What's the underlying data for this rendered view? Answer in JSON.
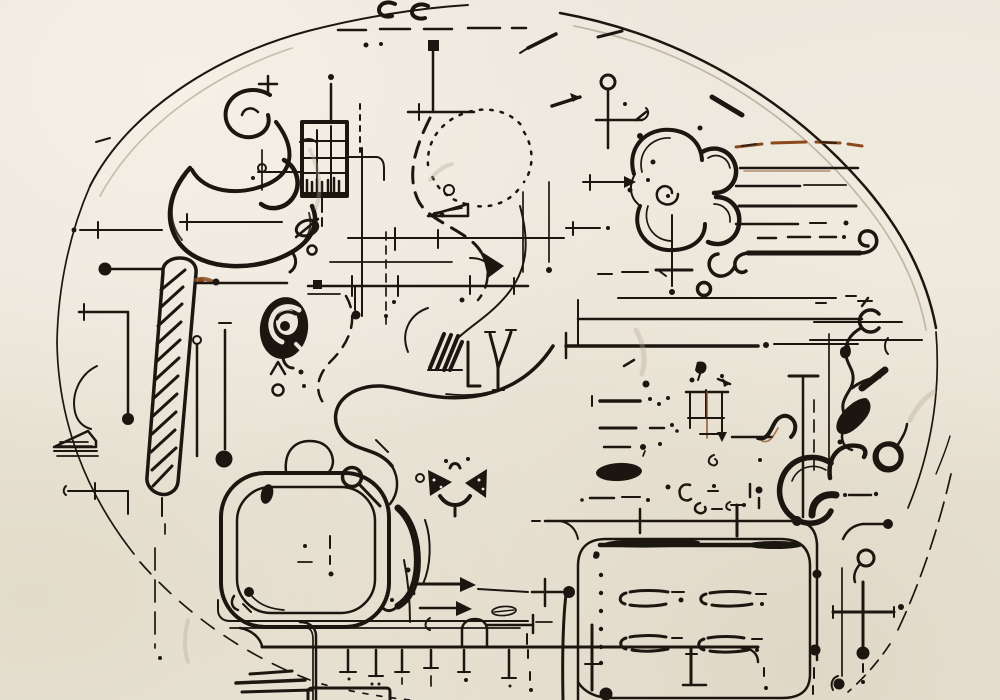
{
  "artwork": {
    "kind": "hand-drawn abstract schematic doodle",
    "description": "Black ink circuit-style sketch drawn inside a large irregular circle on cream paper; no readable text, only abstract glyph-like marks",
    "canvas": {
      "width": 1000,
      "height": 700
    },
    "colors": {
      "paper": "#ece7dc",
      "paper_shadow": "#ded7c8",
      "ink": "#1c1611",
      "ink_soft": "#3a3128",
      "rust": "#8a4a1e",
      "faint": "#b5a793"
    },
    "components": [
      "outer-circle-boundary",
      "cc-glyphs",
      "top-dash-line",
      "top-pin-square",
      "grid-module",
      "swirl-doodle",
      "theta-mark",
      "dotted-blob",
      "pin-with-circle-head",
      "clover-loop",
      "horizontal-line-stack",
      "hooked-bar",
      "seahorse-hook",
      "mid-right-dotted-module",
      "ink-lens",
      "small-grid-frame",
      "wave-connector",
      "big-c-ring",
      "hatched-capsule",
      "ear-blob",
      "winding-path",
      "hatch-patch",
      "wishbone-glyphs",
      "valve-blob",
      "squircle-coil",
      "left-elbow-pipe",
      "left-arc",
      "hatched-wedge",
      "left-verticals",
      "comb-pipe",
      "hamburger-lines",
      "bottom-rect",
      "dashed-panel",
      "panel-pill-brackets",
      "panel-top-pipes",
      "right-circuit-pipes",
      "boundary-dashes"
    ]
  }
}
